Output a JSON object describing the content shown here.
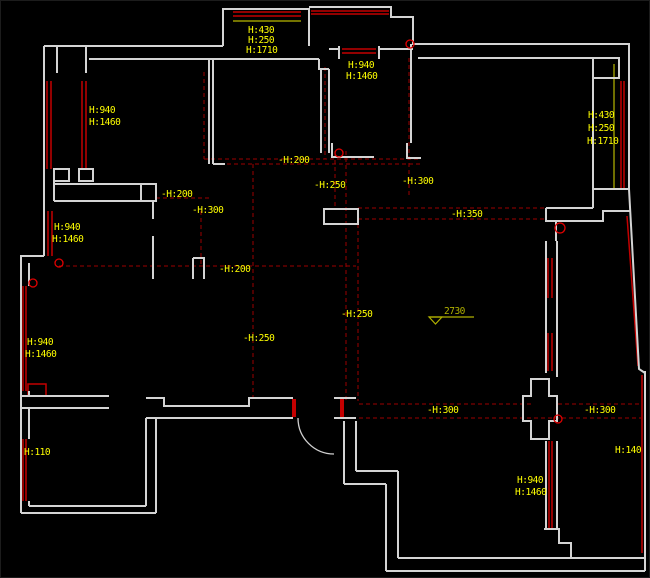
{
  "app": {
    "title": "CAD floor plan drawing",
    "canvas": {
      "width": 650,
      "height": 578,
      "background": "#000000"
    }
  },
  "colors": {
    "wall": "#d4d4d4",
    "window": "#c40000",
    "dashed": "#9b0000",
    "circle": "#e00000",
    "label": "#ffff00",
    "level": "#b0b000",
    "yellow_line": "#b8b800",
    "door": "#cfcfcf"
  },
  "labels": [
    {
      "text": "H:430",
      "x": 247,
      "y": 32
    },
    {
      "text": "H:250",
      "x": 247,
      "y": 42
    },
    {
      "text": "H:1710",
      "x": 245,
      "y": 52
    },
    {
      "text": "H:940",
      "x": 347,
      "y": 67
    },
    {
      "text": "H:1460",
      "x": 345,
      "y": 78
    },
    {
      "text": "H:940",
      "x": 88,
      "y": 112
    },
    {
      "text": "H:1460",
      "x": 88,
      "y": 124
    },
    {
      "text": "H:430",
      "x": 587,
      "y": 117
    },
    {
      "text": "H:250",
      "x": 587,
      "y": 130
    },
    {
      "text": "H:1710",
      "x": 586,
      "y": 143
    },
    {
      "text": "-H:200",
      "x": 160,
      "y": 196
    },
    {
      "text": "-H:300",
      "x": 191,
      "y": 212
    },
    {
      "text": "-H:200",
      "x": 277,
      "y": 162
    },
    {
      "text": "-H:250",
      "x": 313,
      "y": 187
    },
    {
      "text": "-H:300",
      "x": 401,
      "y": 183
    },
    {
      "text": "-H:350",
      "x": 450,
      "y": 216
    },
    {
      "text": "-H:200",
      "x": 218,
      "y": 271
    },
    {
      "text": "H:940",
      "x": 53,
      "y": 229
    },
    {
      "text": "H:1460",
      "x": 51,
      "y": 241
    },
    {
      "text": "H:940",
      "x": 26,
      "y": 344
    },
    {
      "text": "H:1460",
      "x": 24,
      "y": 356
    },
    {
      "text": "-H:250",
      "x": 242,
      "y": 340
    },
    {
      "text": "-H:250",
      "x": 340,
      "y": 316
    },
    {
      "text": "-H:300",
      "x": 426,
      "y": 412
    },
    {
      "text": "-H:300",
      "x": 583,
      "y": 412
    },
    {
      "text": "H:140",
      "x": 614,
      "y": 452
    },
    {
      "text": "H:110",
      "x": 23,
      "y": 454
    },
    {
      "text": "H:940",
      "x": 516,
      "y": 482
    },
    {
      "text": "H:1460",
      "x": 514,
      "y": 494
    }
  ],
  "level_mark": {
    "text": "2730",
    "x": 443,
    "y": 313,
    "line": "M428,316 H473",
    "triangle": "428,316 441,316 434.5,323"
  },
  "geometry": {
    "walls": [
      "M43,45 H222",
      "M222,45 V8 H308 V45",
      "M308,6 H390 V16 H412 V43 H628 V188",
      "M592,188 H628",
      "M592,188 V207",
      "M56,45 V72",
      "M85,45 V72",
      "M88,58 H208",
      "M53,168 H68 V180 H53 Z",
      "M78,168 H92 V180 H78 Z",
      "M208,58 V163",
      "M212,58 V163",
      "M212,163 H224",
      "M208,58 H318",
      "M318,58 V68 H328",
      "M320,68 V152",
      "M328,68 V152",
      "M331,142 V156 H373",
      "M338,45 V58",
      "M378,45 V58",
      "M328,48 H338",
      "M378,48 H412",
      "M406,142 V157 H420",
      "M410,43 V142",
      "M417,57 H592",
      "M592,57 H618 V77 H592 Z",
      "M592,57 V188",
      "M43,45 V255",
      "M53,170 V200",
      "M53,183 H155",
      "M53,200 H140",
      "M140,183 H155 V200 H140 Z",
      "M152,200 V218",
      "M152,235 V278",
      "M192,257 V278",
      "M192,257 H203 V278",
      "M43,255 H20 V512",
      "M20,512 H155",
      "M28,262 V285",
      "M28,390 V395",
      "M28,407 V438",
      "M28,500 V505",
      "M28,505 H145",
      "M20,395 H108",
      "M20,407 H108",
      "M145,417 V505",
      "M155,417 V512",
      "M145,397 H163 V405 H248 V397 H292",
      "M145,417 H292",
      "M333,397 H355",
      "M333,417 H355",
      "M343,420 V483",
      "M355,420 V470",
      "M355,470 H397",
      "M343,483 H385",
      "M385,483 V570",
      "M397,470 V557",
      "M397,557 H643",
      "M385,570 H644",
      "M644,370 V570",
      "M323,208 H357 V223 H323 Z",
      "M545,207 H592",
      "M545,207 V220 H555 V240",
      "M555,220 H602 V210 H630",
      "M545,240 V372",
      "M556,240 V376",
      "M530,378 H548 V395 H556 V420 H548 V438 H530 V420 H522 V395 H530 Z",
      "M545,440 V528",
      "M556,440 V528",
      "M543,528 H558 V542 H570 V557",
      "M628,188 L638,368 L644,372"
    ],
    "windows": [
      "M232,11 H300",
      "M232,15 H300",
      "M310,10 H388",
      "M310,13 H388",
      "M341,48 H375",
      "M341,52 H375",
      "M46,80 V168",
      "M50,80 V168",
      "M81,80 V168",
      "M85,80 V168",
      "M47,210 V255",
      "M51,210 V255",
      "M22,285 V390",
      "M25,285 V390",
      "M22,438 V500",
      "M25,438 V500",
      "M620,80 V187",
      "M623,80 V187",
      "M548,440 V528",
      "M551,440 V528",
      "M641,374 V552",
      "M626,215 L637,365",
      "M547,257 V297",
      "M551,257 V297",
      "M547,332 V370",
      "M551,332 V370",
      "M27,383 H45 V395 H27 Z"
    ],
    "door_jambs": [
      "M293,398 V416",
      "M341,398 V416"
    ],
    "dashed": [
      "M203,71 V158",
      "M324,66 V158",
      "M203,158 H420",
      "M212,163 H420",
      "M408,57 V195",
      "M252,163 V397",
      "M334,152 V208",
      "M345,150 V400",
      "M357,223 V400",
      "M357,207 H545",
      "M357,218 H545",
      "M358,403 H533",
      "M557,403 H640",
      "M358,417 H640",
      "M58,265 H355",
      "M155,197 H208",
      "M200,210 V265"
    ],
    "yellow_lines": [
      "M613,63 V187",
      "M232,20 H300"
    ],
    "circles": [
      {
        "cx": 338,
        "cy": 152,
        "r": 4
      },
      {
        "cx": 409,
        "cy": 43,
        "r": 4
      },
      {
        "cx": 58,
        "cy": 262,
        "r": 4
      },
      {
        "cx": 32,
        "cy": 282,
        "r": 4
      },
      {
        "cx": 559,
        "cy": 227,
        "r": 5
      },
      {
        "cx": 557,
        "cy": 418,
        "r": 4
      }
    ],
    "door_arc": "M297,417 A36,36 0 0 0 333,453"
  }
}
